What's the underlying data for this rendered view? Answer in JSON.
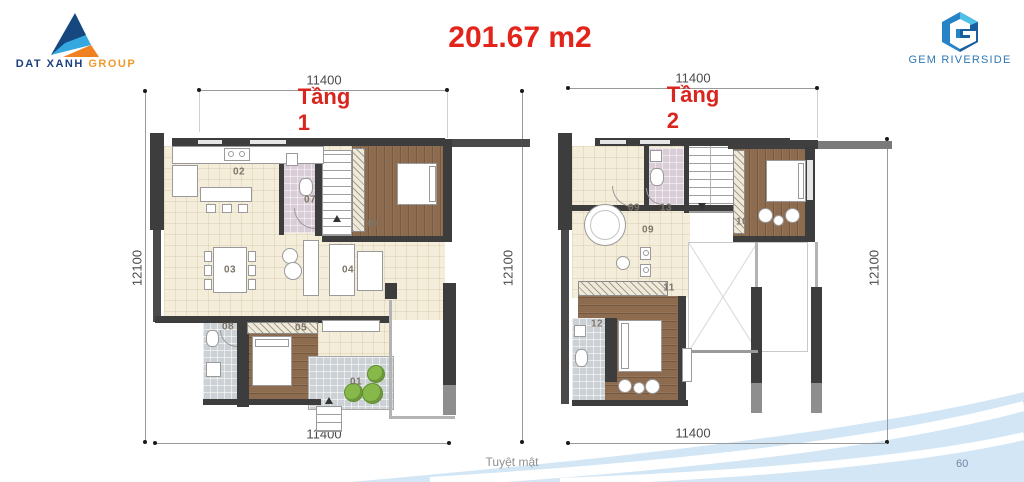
{
  "header": {
    "area": "201.67 m2"
  },
  "logos": {
    "datxanh": {
      "line1": "DAT XANH",
      "line2": "GROUP"
    },
    "gem": {
      "name": "GEM RIVERSIDE"
    }
  },
  "floors": [
    {
      "title": "Tầng 1",
      "dim_top": "11400",
      "dim_bottom": "11400",
      "dim_left": "12100",
      "dim_right": "12100",
      "rooms": {
        "r01": "01",
        "r02": "02",
        "r03": "03",
        "r04": "04",
        "r05": "05",
        "r06": "06",
        "r07": "07",
        "r08": "08"
      }
    },
    {
      "title": "Tầng 2",
      "dim_top": "11400",
      "dim_bottom": "11400",
      "dim_right": "12100",
      "rooms": {
        "r09door": "09",
        "r13": "13",
        "r09": "09",
        "r10": "10",
        "r11": "11",
        "r12": "12"
      }
    }
  ],
  "footer": {
    "confidential": "Tuyệt mật",
    "page": "60"
  },
  "colors": {
    "accent_red": "#e3241b",
    "wall": "#3d3d3d",
    "wood": "#8d6b4e",
    "cream_floor": "#f4edda",
    "gray_tile": "#ccd1d5",
    "bath_lavender": "#d9cdd7",
    "wave_blue": "#d2e6f5",
    "logo_navy": "#1c3f7e",
    "logo_orange": "#f09a2c",
    "gem_blue": "#2f77b5",
    "plant_green": "#86b84a"
  }
}
